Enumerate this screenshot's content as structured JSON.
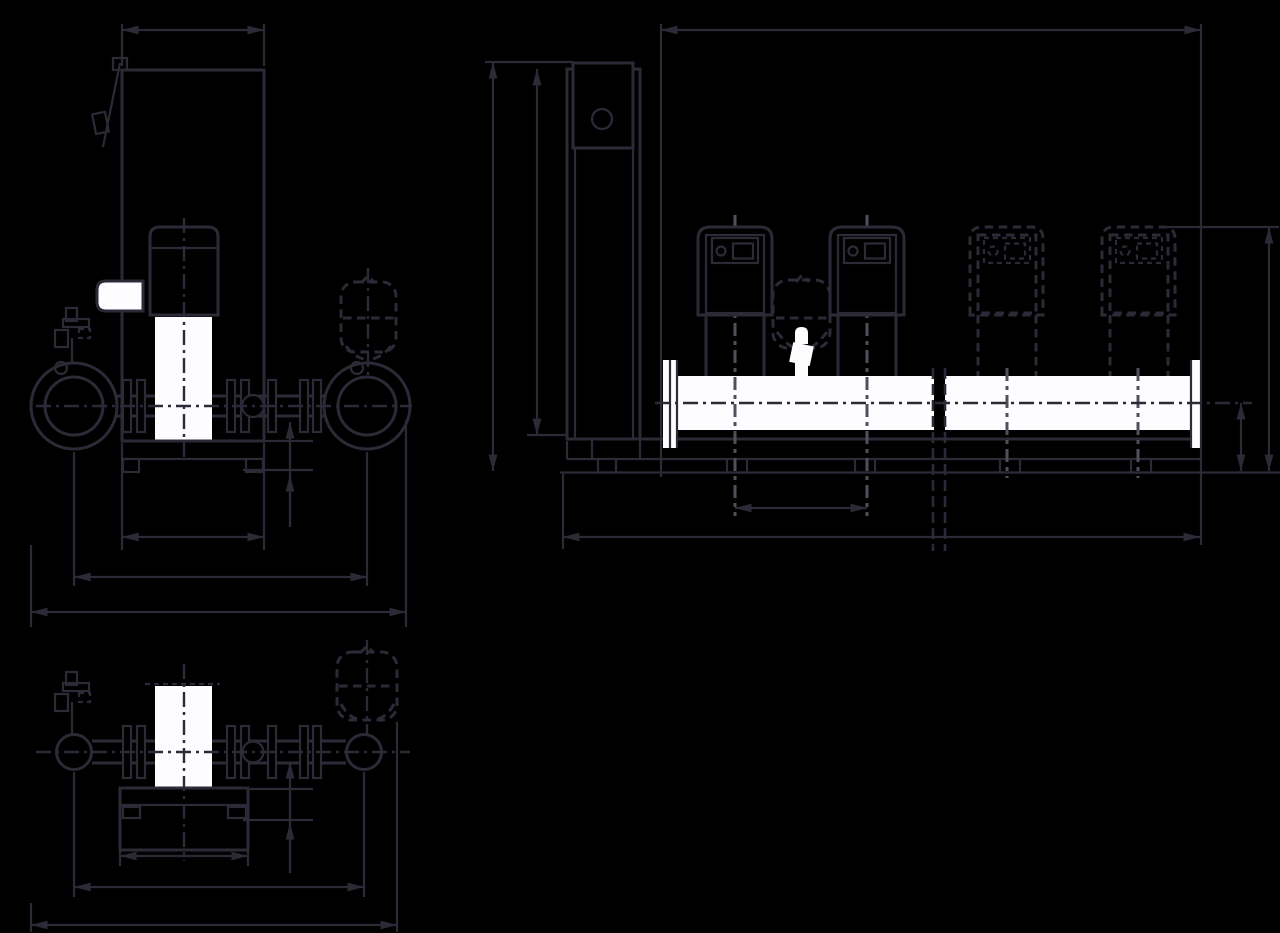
{
  "meta": {
    "title": "Pressure boosting system - dimensional outline drawing",
    "drawing_type": "technical-dimension-drawing",
    "text_on_image": "none"
  },
  "colors": {
    "background": "#000000",
    "line": "#2c2a36",
    "cline": "#524f5c",
    "white": "#fdfdff"
  },
  "views": [
    {
      "id": "side-view",
      "label": "side elevation (single pump with control cabinet)"
    },
    {
      "id": "front-view",
      "label": "front elevation (manifold with 2 solid + 2 dashed optional pumps)"
    },
    {
      "id": "plan-view",
      "label": "top view (single pump on base frame)"
    }
  ],
  "components": [
    "control-cabinet",
    "controller-box",
    "motor",
    "pump-body",
    "suction-port-flange",
    "discharge-port-flange",
    "shutoff-ball-valve",
    "pipe-flange",
    "air-release-valve",
    "diaphragm-pressure-vessel",
    "fill-valve",
    "manifold-pipe",
    "manifold-end-flange",
    "base-frame",
    "foot-pad",
    "floor-line",
    "pipe-break-lines",
    "optional-pump-dashed"
  ],
  "dimensions_shown": [
    "cabinet-width-top",
    "base-width",
    "port-centerline-span",
    "overall-width",
    "pipe-height-above-base",
    "overall-length-top",
    "total-height",
    "cabinet-height",
    "pump-top-height",
    "manifold-centerline-height",
    "pump-spacing",
    "base-length-bottom"
  ],
  "dimension_values_visible": false
}
